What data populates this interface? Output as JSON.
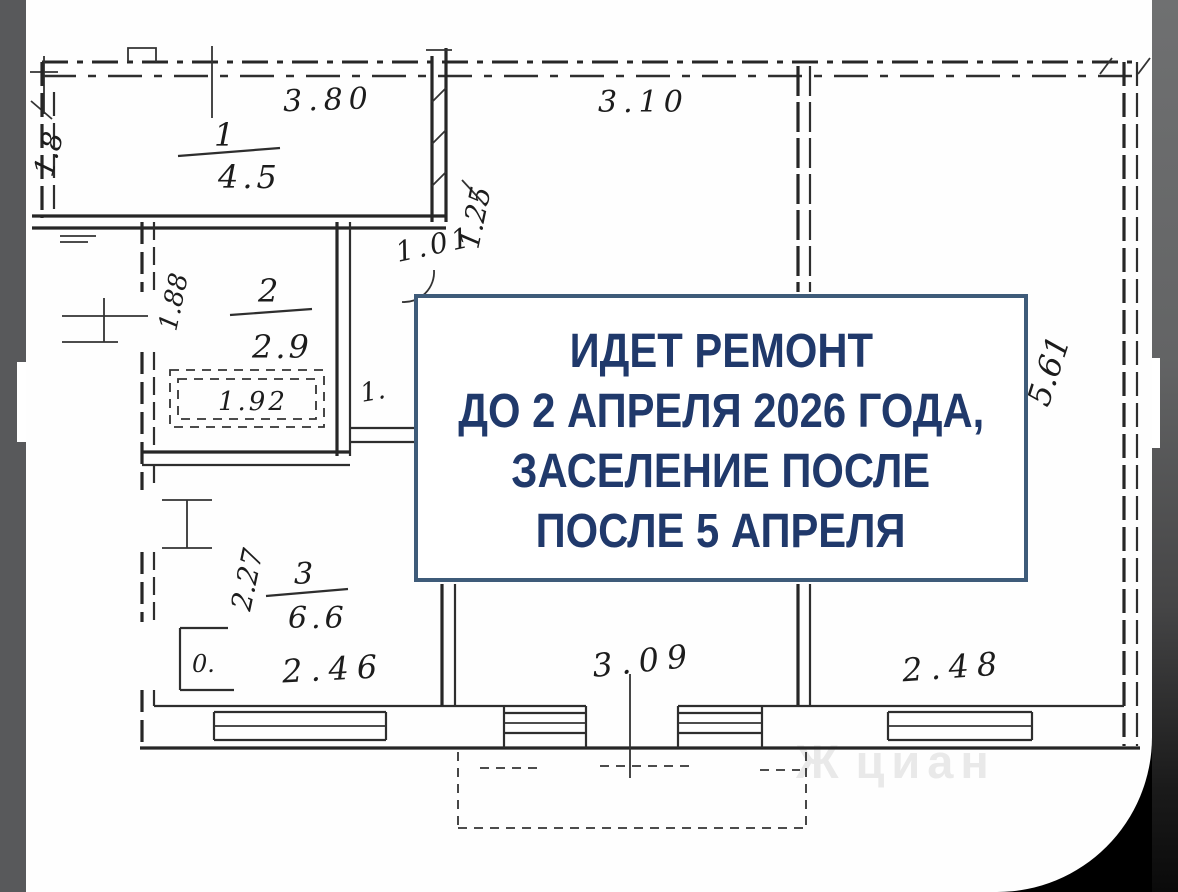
{
  "sign": {
    "line1": "ИДЕТ РЕМОНТ",
    "line2": "ДО 2 АПРЕЛЯ 2026 ГОДА,",
    "line3": "ЗАСЕЛЕНИЕ ПОСЛЕ",
    "line4": "ПОСЛЕ 5 АПРЕЛЯ",
    "text_color": "#20396b",
    "border_color": "#3e5b79",
    "background": "#ffffff"
  },
  "floor_plan": {
    "rooms": {
      "room1": {
        "number": "1",
        "area": "4.5"
      },
      "room2": {
        "number": "2",
        "area": "2.9"
      },
      "room3": {
        "number": "3",
        "area": "6.6"
      }
    },
    "dimensions": {
      "top_left_width": "3.80",
      "top_right_width": "3.10",
      "left_height": "1.8",
      "hall_width": "1.25",
      "hall_door": "1.01",
      "bath_left_height": "1.88",
      "bathtub": "1.92",
      "room3_left_height": "2.27",
      "room3_width": "2.46",
      "bottom_center_width": "3.09",
      "bottom_right_width": "2.48",
      "right_height": "5.61",
      "small_door": "1.",
      "closet": "0."
    },
    "ink_color": "#262626"
  },
  "watermark": {
    "logo_glyph": "Ж",
    "text": "циан"
  },
  "frame": {
    "left_strip_color": "#58595b",
    "right_strip_top_color": "#6f7071",
    "corner_color": "#000000"
  }
}
